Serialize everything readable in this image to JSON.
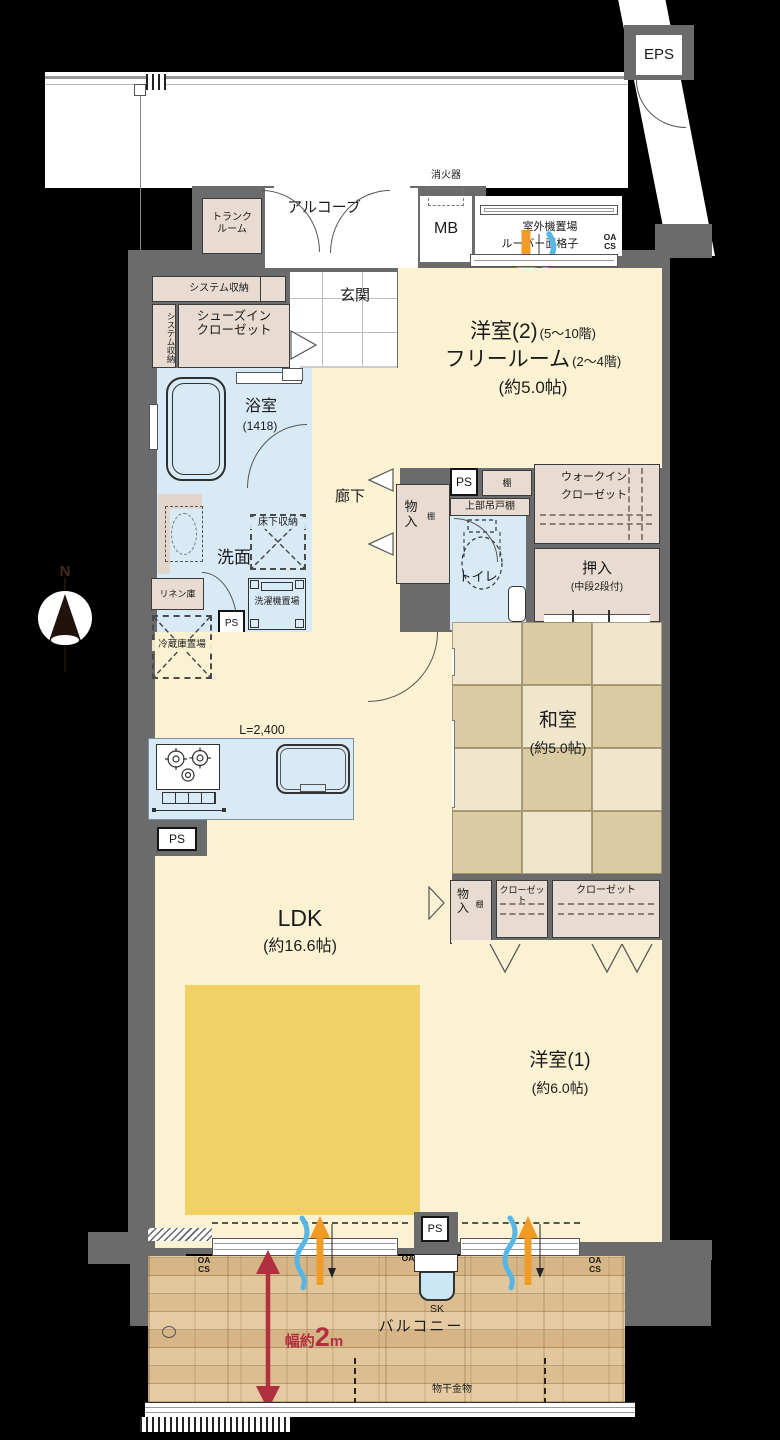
{
  "exterior": {
    "eps": "EPS",
    "trunk_room": "トランク\nルーム",
    "alcove": "アルコーブ",
    "fire_extinguisher": "消火器",
    "meter_box": "MB",
    "outdoor_unit": "室外機置場",
    "louver_grille": "ルーバー面格子",
    "oa_cs_top": "OA\nCS"
  },
  "entry": {
    "genkan": "玄関",
    "system_storage": "システム収納",
    "system_storage_side": "システム収納",
    "shoe_closet_line1": "シューズイン",
    "shoe_closet_line2": "クローゼット"
  },
  "western_room_2": {
    "name": "洋室(2)",
    "floors_high": "(5〜10階)",
    "alt_name": "フリールーム",
    "floors_low": "(2〜4階)",
    "size": "(約5.0帖)"
  },
  "bathroom": {
    "name": "浴室",
    "size": "(1418)"
  },
  "hallway": {
    "name": "廊下",
    "storage": "物\n入",
    "storage_shelf": "棚",
    "ps": "PS",
    "shelf": "棚",
    "upper_cabinet": "上部吊戸棚"
  },
  "walk_in_closet": {
    "line1": "ウォークイン",
    "line2": "クローゼット"
  },
  "toilet": {
    "name": "トイレ"
  },
  "oshiire": {
    "name": "押入",
    "note": "(中段2段付)"
  },
  "washroom": {
    "name": "洗面",
    "underfloor_storage": "床下収納",
    "linen": "リネン庫",
    "washer": "洗濯機置場",
    "ps": "PS"
  },
  "kitchen": {
    "counter_length": "L=2,400",
    "fridge_space": "冷蔵庫置場",
    "ps": "PS"
  },
  "japanese_room": {
    "name": "和室",
    "size": "(約5.0帖)"
  },
  "ldk": {
    "name": "LDK",
    "size": "(約16.6帖)"
  },
  "storage_row": {
    "storage": "物\n入",
    "storage_shelf": "棚",
    "closet_small": "クローゼット",
    "closet_large": "クローゼット"
  },
  "western_room_1": {
    "name": "洋室(1)",
    "size": "(約6.0帖)"
  },
  "balcony": {
    "name": "バルコニー",
    "width_prefix": "幅約",
    "width_value": "2",
    "width_unit": "m",
    "sk": "SK",
    "ps": "PS",
    "drying_hardware": "物干金物",
    "oa_cs_left": "OA\nCS",
    "oa_mid": "OA",
    "oa_cs_right": "OA\nCS"
  },
  "compass": {
    "north": "N"
  },
  "colors": {
    "wall": "#6b6b6b",
    "room": "#fbf2d3",
    "water": "#d8eaf6",
    "closet": "#e8dbd1",
    "tatami_light": "#efe6cb",
    "tatami_dark": "#dacba3",
    "rug": "#f1d065",
    "accent_red": "#b03040",
    "arrow_orange": "#f09a28",
    "arrow_blue": "#56b7e6"
  }
}
